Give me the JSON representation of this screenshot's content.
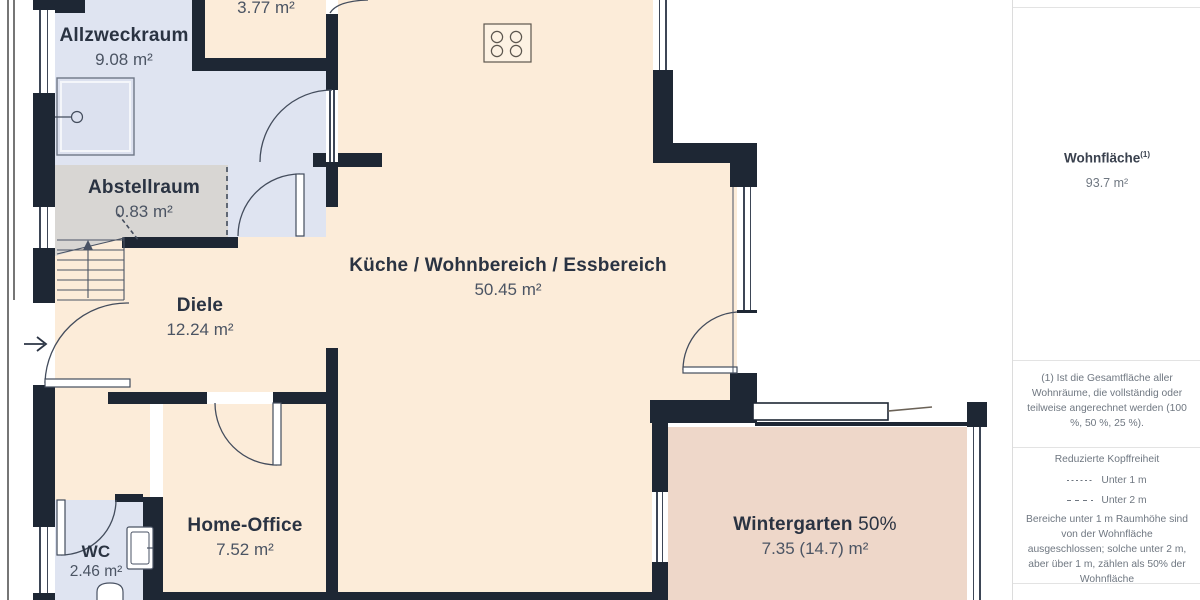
{
  "plan": {
    "rooms": [
      {
        "id": "allzweckraum",
        "name": "Allzweckraum",
        "area": "9.08 m²"
      },
      {
        "id": "room_377",
        "name": "",
        "area": "3.77 m²"
      },
      {
        "id": "abstellraum",
        "name": "Abstellraum",
        "area": "0.83 m²"
      },
      {
        "id": "diele",
        "name": "Diele",
        "area": "12.24 m²"
      },
      {
        "id": "kueche",
        "name": "Küche / Wohnbereich / Essbereich",
        "area": "50.45 m²"
      },
      {
        "id": "home_office",
        "name": "Home-Office",
        "area": "7.52 m²"
      },
      {
        "id": "wc",
        "name": "WC",
        "area": "2.46 m²"
      },
      {
        "id": "wintergarten",
        "name": "Wintergarten",
        "suffix": "50%",
        "area": "7.35 (14.7) m²"
      }
    ],
    "icons": [
      "stove-icon",
      "shower-icon",
      "sink-icon",
      "toilet-icon",
      "stairs-icon",
      "entry-arrow-icon"
    ]
  },
  "sidebar": {
    "heading": "Wohnfläche",
    "heading_sup": "(1)",
    "total": "93.7 m²",
    "footnote": "(1) Ist die Gesamtfläche aller Wohnräume, die vollständig oder teilweise angerechnet werden (100 %, 50 %, 25 %).",
    "legend_title": "Reduzierte Kopffreiheit",
    "legend": [
      {
        "style": "fine-dashed",
        "label": "Unter 1 m"
      },
      {
        "style": "dashed",
        "label": "Unter 2 m"
      }
    ],
    "note": "Bereiche unter 1 m Raumhöhe sind von der Wohnfläche ausgeschlossen; solche unter 2 m, aber über 1 m, zählen als 50% der Wohnfläche"
  },
  "colors": {
    "wall": "#1e2734",
    "room_living": "#fcecd9",
    "room_utility": "#dfe4f1",
    "room_storage": "#d8d6d3",
    "room_wintergarten": "#eed7c9",
    "label_dark": "#2a3342",
    "label_muted": "#4b5463",
    "sidebar_text": "#6f7781",
    "divider": "#e3e3e3"
  }
}
